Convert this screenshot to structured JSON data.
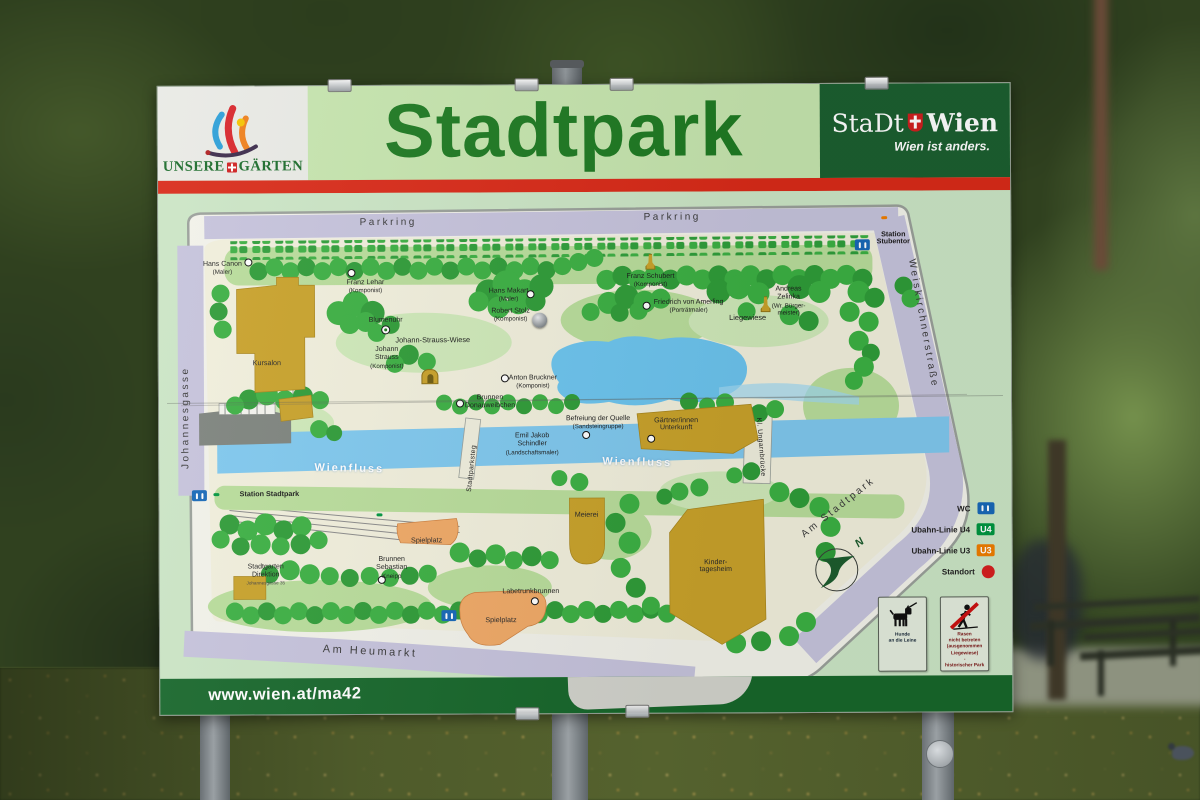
{
  "sign": {
    "header": {
      "logo": {
        "name1": "UNSERE",
        "name2": "GÄRTEN"
      },
      "title": "Stadtpark",
      "brand": {
        "name1": "StaDt",
        "name2": "Wien",
        "slogan": "Wien ist anders."
      }
    },
    "footer": {
      "url": "www.wien.at/ma42"
    }
  },
  "map": {
    "labels": [
      {
        "l1": "Parkring",
        "x": 230,
        "y": 30,
        "cls": "street"
      },
      {
        "l1": "Parkring",
        "x": 514,
        "y": 26,
        "cls": "street"
      },
      {
        "l1": "Johannesgasse",
        "x": 27,
        "y": 224,
        "cls": "street rotl90"
      },
      {
        "l1": "Weiskirchnerstraße",
        "x": 764,
        "y": 133,
        "cls": "street rot80"
      },
      {
        "l1": "Am Stadtpark",
        "x": 679,
        "y": 317,
        "cls": "street rotm38"
      },
      {
        "l1": "Am Heumarkt",
        "x": 210,
        "y": 459,
        "cls": "street big rot4"
      },
      {
        "l1": "Stadtparksteg",
        "x": 313,
        "y": 276,
        "cls": "bridge rotm84"
      },
      {
        "l1": "Kl. Ungarnbrücke",
        "x": 601,
        "y": 256,
        "cls": "bridge rot86"
      },
      {
        "l1": "Wienfluss",
        "x": 190,
        "y": 276,
        "cls": "river rot2"
      },
      {
        "l1": "Wienfluss",
        "x": 478,
        "y": 271,
        "cls": "river rot2"
      },
      {
        "l1": "Station",
        "l2": "Stubentor",
        "x": 735,
        "y": 48,
        "cls": "station eq"
      },
      {
        "l1": "Station Stadtpark",
        "x": 110,
        "y": 301,
        "cls": "station"
      },
      {
        "l1": "Hans Canon",
        "l2": "(Maler)",
        "x": 64,
        "y": 75
      },
      {
        "l1": "Franz Lehar",
        "l2": "(Komponist)",
        "x": 207,
        "y": 94
      },
      {
        "l1": "Hans Makart",
        "l2": "(Maler)",
        "x": 350,
        "y": 103
      },
      {
        "l1": "Robert Stolz",
        "l2": "(Komponist)",
        "x": 352,
        "y": 123
      },
      {
        "l1": "Franz Schubert",
        "l2": "(Komponist)",
        "x": 492,
        "y": 89
      },
      {
        "l1": "Friedrich von Amerling",
        "l2": "(Porträtmaler)",
        "x": 530,
        "y": 115
      },
      {
        "l1": "Liegewiese",
        "x": 589,
        "y": 127,
        "cls": "area"
      },
      {
        "l1": "Andreas",
        "l2": "Zelinka",
        "l3": "(Wr. Bürger-",
        "l4": "meister)",
        "x": 630,
        "y": 110,
        "cls": "eq"
      },
      {
        "l1": "Johann-Strauss-Wiese",
        "x": 274,
        "y": 148,
        "cls": "area"
      },
      {
        "l1": "Blumenuhr",
        "x": 227,
        "y": 128
      },
      {
        "l1": "Johann",
        "l2": "Strauss",
        "l3": "(Komponist)",
        "x": 228,
        "y": 165,
        "cls": "eq"
      },
      {
        "l1": "Anton Bruckner",
        "l2": "(Komponist)",
        "x": 374,
        "y": 190
      },
      {
        "l1": "Brunnen",
        "l2": "Donauweibchen",
        "x": 331,
        "y": 210,
        "cls": "eq"
      },
      {
        "l1": "Befreiung der Quelle",
        "l2": "(Sandsteingruppe)",
        "x": 439,
        "y": 231
      },
      {
        "l1": "Emil Jakob",
        "l2": "Schindler",
        "l3": "(Landschaftsmaler)",
        "x": 373,
        "y": 252,
        "cls": "eq"
      },
      {
        "l1": "Gärtner/innen",
        "l2": "Unterkunft",
        "x": 517,
        "y": 233,
        "cls": "eq bldg"
      },
      {
        "l1": "Kursalon",
        "x": 108,
        "y": 170,
        "cls": "bldg"
      },
      {
        "l1": "Stadtgarten",
        "l2": "Direktion",
        "l3": "Johannesgasse 35",
        "x": 106,
        "y": 381,
        "cls": "eq tiny3"
      },
      {
        "l1": "Spielplatz",
        "x": 267,
        "y": 348,
        "cls": "bldg"
      },
      {
        "l1": "Brunnen",
        "l2": "Sebastian",
        "l3": "Kneipp",
        "x": 232,
        "y": 375,
        "cls": "eq"
      },
      {
        "l1": "Labetrunkbrunnen",
        "x": 371,
        "y": 400
      },
      {
        "l1": "Spielplatz",
        "x": 341,
        "y": 428,
        "cls": "bldg"
      },
      {
        "l1": "Meierei",
        "x": 427,
        "y": 323,
        "cls": "bldg"
      },
      {
        "l1": "Kinder-",
        "l2": "tagesheim",
        "x": 556,
        "y": 375,
        "cls": "eq bldg"
      }
    ],
    "points": [
      {
        "t": "u3",
        "s": "U3",
        "x": 726,
        "y": 27
      },
      {
        "t": "u4",
        "s": "U4",
        "x": 57,
        "y": 301
      },
      {
        "t": "u4",
        "s": "U4",
        "x": 220,
        "y": 322
      },
      {
        "t": "wc",
        "x": 40,
        "y": 298
      },
      {
        "t": "wc",
        "x": 689,
        "y": 50
      },
      {
        "t": "wc",
        "x": 259,
        "y": 419
      },
      {
        "t": "dot",
        "x": 90,
        "y": 69
      },
      {
        "t": "dot",
        "x": 193,
        "y": 80
      },
      {
        "t": "dot",
        "x": 372,
        "y": 102
      },
      {
        "t": "bolt",
        "x": 381,
        "y": 128
      },
      {
        "t": "statue",
        "x": 492,
        "y": 70
      },
      {
        "t": "dot",
        "x": 488,
        "y": 114
      },
      {
        "t": "statue",
        "x": 607,
        "y": 113
      },
      {
        "t": "target",
        "x": 227,
        "y": 137
      },
      {
        "t": "arch",
        "x": 226,
        "y": 184
      },
      {
        "t": "dot",
        "x": 346,
        "y": 186
      },
      {
        "t": "dot",
        "x": 301,
        "y": 211
      },
      {
        "t": "dot",
        "x": 427,
        "y": 243
      },
      {
        "t": "dot",
        "x": 492,
        "y": 247
      },
      {
        "t": "dot",
        "x": 222,
        "y": 387
      },
      {
        "t": "dot",
        "x": 375,
        "y": 409
      },
      {
        "t": "arrow",
        "s": "→",
        "x": 247,
        "y": 277
      },
      {
        "t": "arrow",
        "s": "→",
        "x": 553,
        "y": 249
      },
      {
        "t": "arrow",
        "s": "→",
        "x": 697,
        "y": 250
      }
    ],
    "legend": [
      {
        "label": "WC",
        "t": "wc"
      },
      {
        "label": "Ubahn-Linie U4",
        "t": "u4",
        "sym": "U4"
      },
      {
        "label": "Ubahn-Linie U3",
        "t": "u3",
        "sym": "U3"
      },
      {
        "label": "Standort",
        "t": "reddot"
      }
    ],
    "compass": {
      "n": "N"
    },
    "notices": [
      {
        "t": "dog",
        "text": "Hunde\nan die Leine"
      },
      {
        "t": "nograss",
        "text": "Rasen\nnicht betreten\n(ausgenommen\nLiegewiese)\n-\nhistorischer Park"
      }
    ]
  },
  "colors": {
    "accent_red": "#d92a18",
    "dark_green": "#1c5f30",
    "title_green": "#1e7a22",
    "street_lavender": "#c6c3dc",
    "water_blue": "#7fc8ee",
    "building_ochre": "#c9a22a",
    "playground_orange": "#f0a966",
    "u4_green": "#009640",
    "u3_orange": "#ef7d00",
    "standort_red": "#d61f1f"
  }
}
